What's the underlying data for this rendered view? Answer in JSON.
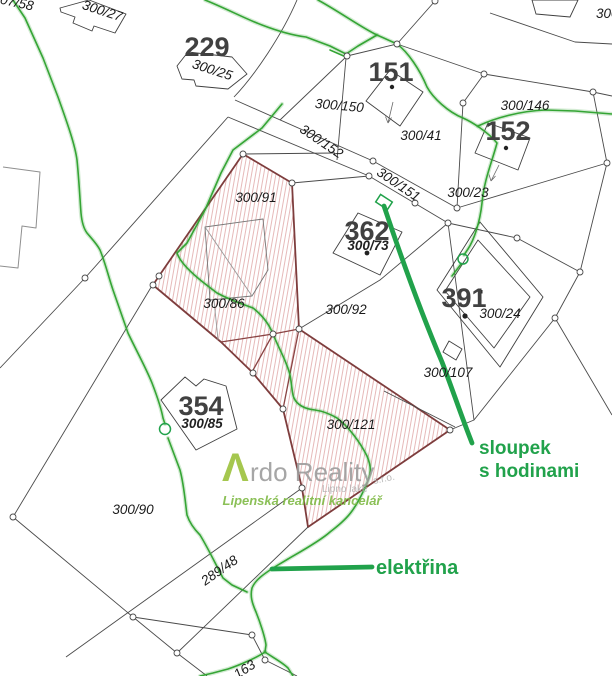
{
  "map": {
    "title": "cadastral parcel map",
    "labels": {
      "p07_58": "07/58",
      "p300_27": "300/27",
      "b229": "229",
      "p300_25": "300/25",
      "b151": "151",
      "p300_150": "300/150",
      "p300_152": "300/152",
      "p300_151": "300/151",
      "p300_41": "300/41",
      "p300_146": "300/146",
      "b152": "152",
      "p300_23": "300/23",
      "p300_91": "300/91",
      "b362": "362",
      "p300_73": "300/73",
      "p300_86": "300/86",
      "p300_92": "300/92",
      "b391": "391",
      "p300_24": "300/24",
      "p300_107": "300/107",
      "b354": "354",
      "p300_85": "300/85",
      "p300_121": "300/121",
      "p300_90": "300/90",
      "p289_48": "289/48",
      "p163": "163",
      "p300_partial": "300"
    },
    "annotations": {
      "sloupek_line1": "sloupek",
      "sloupek_line2": "s hodinami",
      "elektrina": "elektřina"
    },
    "watermark": {
      "logo_letter": "Λ",
      "brand": "rdo Reality",
      "company_suffix": "s.r.o.",
      "sub_brand": "Lipno lake",
      "tagline": "Lipenská realitní kancelář"
    },
    "colors": {
      "utility_line_green": "#35a535",
      "annotation_green": "#21a24b",
      "logo_green": "#9cc13c",
      "tagline_green": "#7fba45",
      "watermark_gray": "#9d9d9d",
      "highlight_boundary_red": "#7e3d3d",
      "hatch_pink": "#e0a8a8",
      "parcel_line_gray": "#4a4a4a",
      "label_black": "#1b1b1b",
      "big_number_gray": "#414141"
    }
  }
}
